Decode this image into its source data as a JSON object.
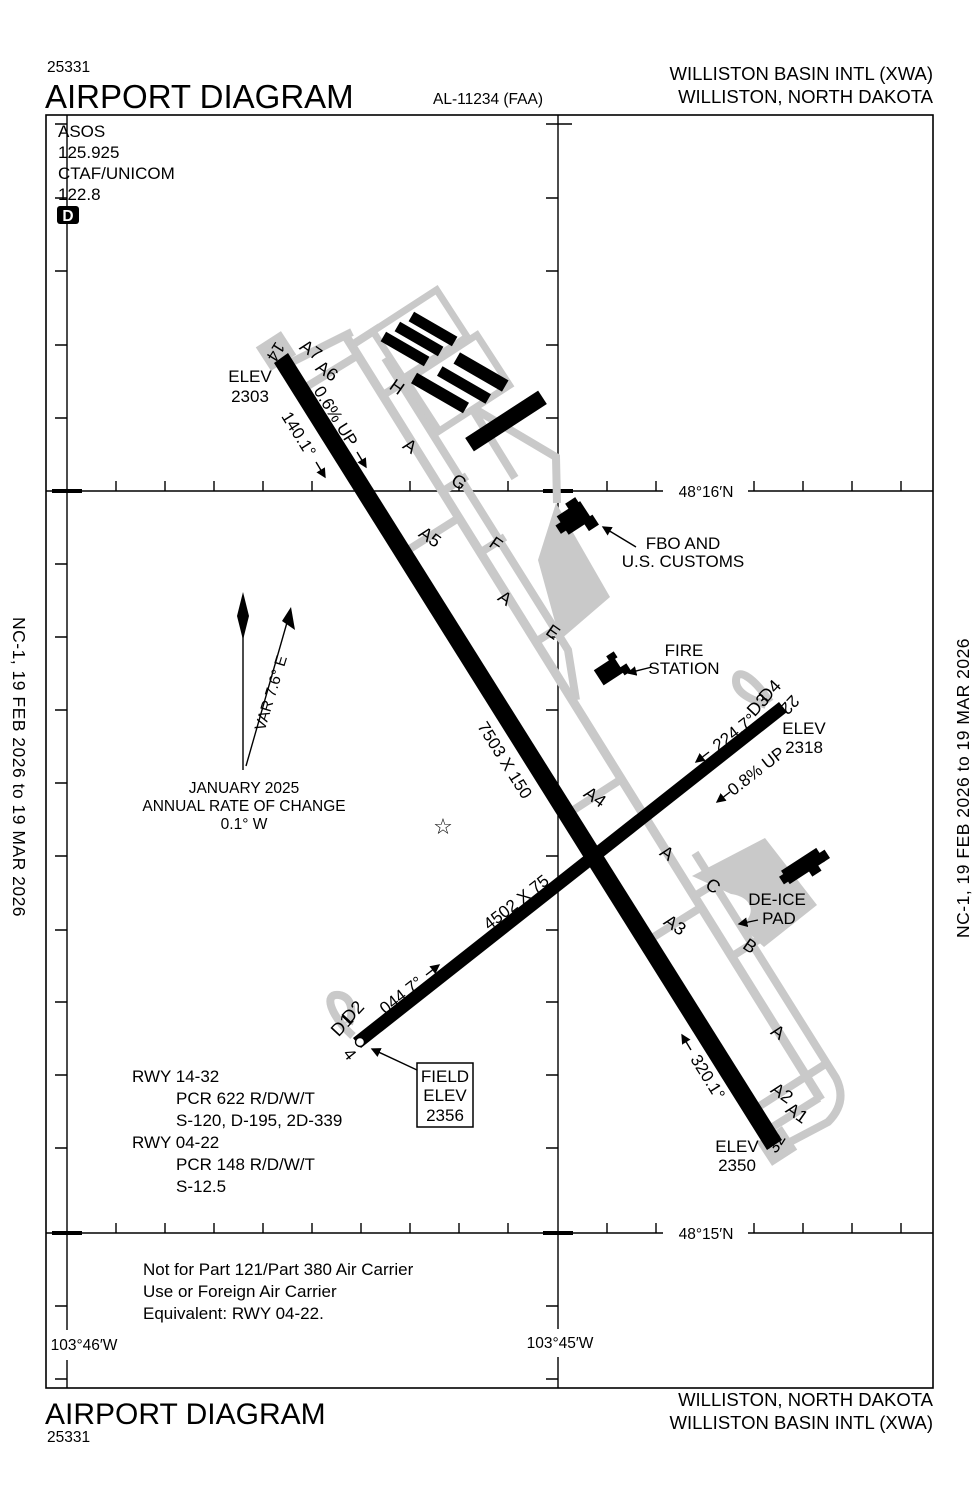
{
  "colors": {
    "ink": "#000000",
    "pavement_gray": "#c9c9c9"
  },
  "header": {
    "chart_number": "25331",
    "title": "AIRPORT DIAGRAM",
    "procedure_id": "AL-11234 (FAA)",
    "airport_name": "WILLISTON BASIN INTL (XWA)",
    "city": "WILLISTON, NORTH DAKOTA"
  },
  "footer": {
    "title": "AIRPORT DIAGRAM",
    "chart_number": "25331",
    "city": "WILLISTON, NORTH DAKOTA",
    "airport_name": "WILLISTON BASIN INTL (XWA)"
  },
  "margin_note": "NC-1,  19 FEB 2026  to  19 MAR 2026",
  "comm": {
    "asos_label": "ASOS",
    "asos_freq": "125.925",
    "ctaf_label": "CTAF/UNICOM",
    "ctaf_freq": "122.8",
    "datalink": "D"
  },
  "graticule": {
    "lat_north": "48°16′N",
    "lat_south": "48°15′N",
    "lon_west": "103°46′W",
    "lon_east": "103°45′W"
  },
  "magnetic": {
    "date": "JANUARY 2025",
    "rate_label": "ANNUAL RATE OF CHANGE",
    "rate": "0.1° W",
    "variation": "VAR 7.6° E"
  },
  "runways": {
    "r1432": {
      "dimensions": "7503 X 150",
      "heading_14": "140.1°",
      "heading_32": "320.1°",
      "gradient": "0.6% UP",
      "threshold_14": "14",
      "threshold_32": "32",
      "elev_label_14": "ELEV",
      "elev_14": "2303",
      "elev_label_32": "ELEV",
      "elev_32": "2350"
    },
    "r0422": {
      "dimensions": "4502 X 75",
      "heading_04": "044.7°",
      "heading_22": "224.7°",
      "gradient": "0.8% UP",
      "threshold_04": "4",
      "threshold_22": "22",
      "elev_label_22": "ELEV",
      "elev_22": "2318"
    }
  },
  "field_elevation": {
    "line1": "FIELD",
    "line2": "ELEV",
    "value": "2356"
  },
  "facilities": {
    "fbo_line1": "FBO AND",
    "fbo_line2": "U.S. CUSTOMS",
    "fire_line1": "FIRE",
    "fire_line2": "STATION",
    "deice_line1": "DE-ICE",
    "deice_line2": "PAD"
  },
  "taxiways": {
    "a1": "A1",
    "a2": "A2",
    "a3": "A3",
    "a4": "A4",
    "a5": "A5",
    "a6": "A6",
    "a7": "A7",
    "b": "B",
    "c": "C",
    "d1": "D1",
    "d2": "D2",
    "d3": "D3",
    "d4": "D4",
    "e": "E",
    "f": "F",
    "g": "G",
    "h": "H",
    "a_labels": [
      "A",
      "A",
      "A",
      "A"
    ]
  },
  "runway_data": {
    "rwy1432_title": "RWY 14-32",
    "rwy1432_pcr": "PCR 622 R/D/W/T",
    "rwy1432_strength": "S-120, D-195, 2D-339",
    "rwy0422_title": "RWY 04-22",
    "rwy0422_pcr": "PCR 148 R/D/W/T",
    "rwy0422_strength": "S-12.5"
  },
  "note": {
    "line1": "Not for Part 121/Part 380 Air Carrier",
    "line2": "Use or Foreign Air Carrier",
    "line3": "Equivalent: RWY 04-22."
  },
  "symbols": {
    "beacon": "☆"
  }
}
